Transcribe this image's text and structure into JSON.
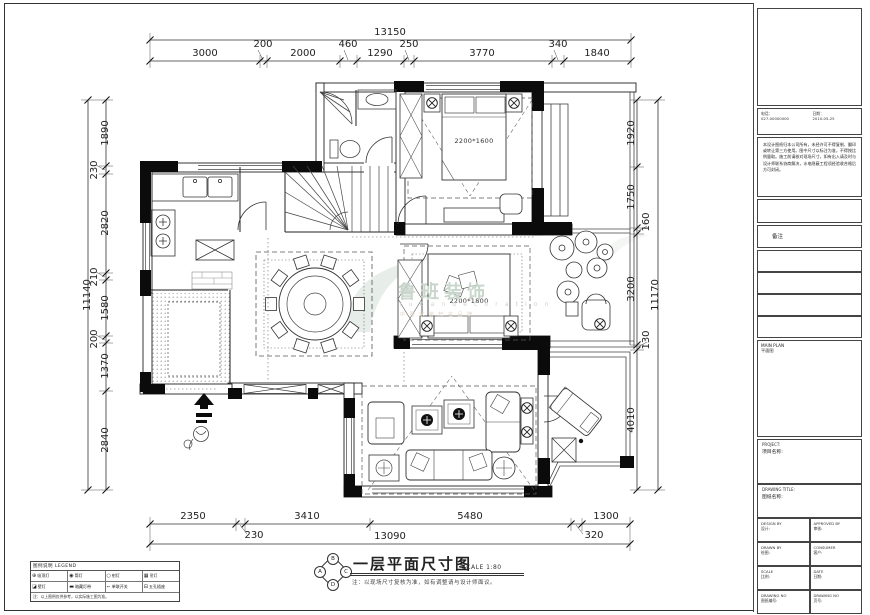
{
  "sheet": {
    "bg": "#ffffff",
    "line": "#1a1a1a",
    "watermark_color": "#c9d6cc"
  },
  "watermark": {
    "cn": "鲁班装饰",
    "en": "l u b a n   d e c o r a t i o n",
    "tagline": "中 国 家 装 知 名 品 牌"
  },
  "plan": {
    "bed1_label": "2200*1600",
    "bed2_label": "2200*1800"
  },
  "dims": {
    "top": {
      "overall": "13150",
      "segments": [
        "3000",
        "200",
        "2000",
        "460",
        "1290",
        "250",
        "3770",
        "340",
        "1840"
      ]
    },
    "bottom": {
      "overall": "13090",
      "segments": [
        "2350",
        "230",
        "3410",
        "5480",
        "320",
        "1300"
      ]
    },
    "left": {
      "overall": "11140",
      "segments": [
        "1890",
        "230",
        "2820",
        "210",
        "1580",
        "200",
        "1370",
        "2840"
      ]
    },
    "right": {
      "overall": "11170",
      "segments": [
        "1920",
        "1750",
        "160",
        "3200",
        "130",
        "4010"
      ]
    }
  },
  "title": {
    "text": "一层平面尺寸图",
    "scale": "SCALE 1:80",
    "note": "注：以现场尺寸复核为准，如有调整请与设计师面议。",
    "stamp": {
      "top": "B",
      "left": "A",
      "right": "C",
      "bottom": "D"
    }
  },
  "legend": {
    "header": "图例说明 LEGEND",
    "items": [
      {
        "symbol": "⊕",
        "label": "吸顶灯"
      },
      {
        "symbol": "◉",
        "label": "筒灯"
      },
      {
        "symbol": "○",
        "label": "射灯"
      },
      {
        "symbol": "▦",
        "label": "吊灯"
      },
      {
        "symbol": "◪",
        "label": "壁灯"
      },
      {
        "symbol": "▬",
        "label": "暗藏灯带"
      },
      {
        "symbol": "⌐",
        "label": "单联开关"
      },
      {
        "symbol": "⊟",
        "label": "五孔插座"
      }
    ],
    "note": "注：以上图例仅供参考，以实际施工图为准。"
  },
  "title_block": {
    "info_left_label": "电话：",
    "info_left_value": "027-00000000",
    "info_right_label": "日期：",
    "info_right_value": "2010-05-25",
    "disclaimer": "本设计图纸归本公司所有，未经许可不得复制、翻印或转让第三方使用。图中尺寸以标注为准，不得按比例量取。施工前请核对现场尺寸，如有出入请及时与设计师联系协商解决，水电隐蔽工程须经验收合格后方可封闭。",
    "remark": "备注",
    "main_plan_en": "MAIN PLAN",
    "main_plan_cn": "平面图",
    "project_en": "PROJECT:",
    "project_cn": "项目名称:",
    "dwg_title_en": "DRAWING TITLE:",
    "dwg_title_cn": "图纸名称:",
    "fields": [
      {
        "en": "DESIGN BY",
        "cn": "设计:"
      },
      {
        "en": "APPROVED BY",
        "cn": "审核:"
      },
      {
        "en": "DRAWN BY",
        "cn": "绘图:"
      },
      {
        "en": "CONSUMER",
        "cn": "客户:"
      },
      {
        "en": "SCALE",
        "cn": "比例:"
      },
      {
        "en": "DATE",
        "cn": "日期:"
      },
      {
        "en": "DRAWING NO",
        "cn": "图纸编号:"
      },
      {
        "en": "DRAWING NO",
        "cn": "页号:"
      }
    ]
  }
}
